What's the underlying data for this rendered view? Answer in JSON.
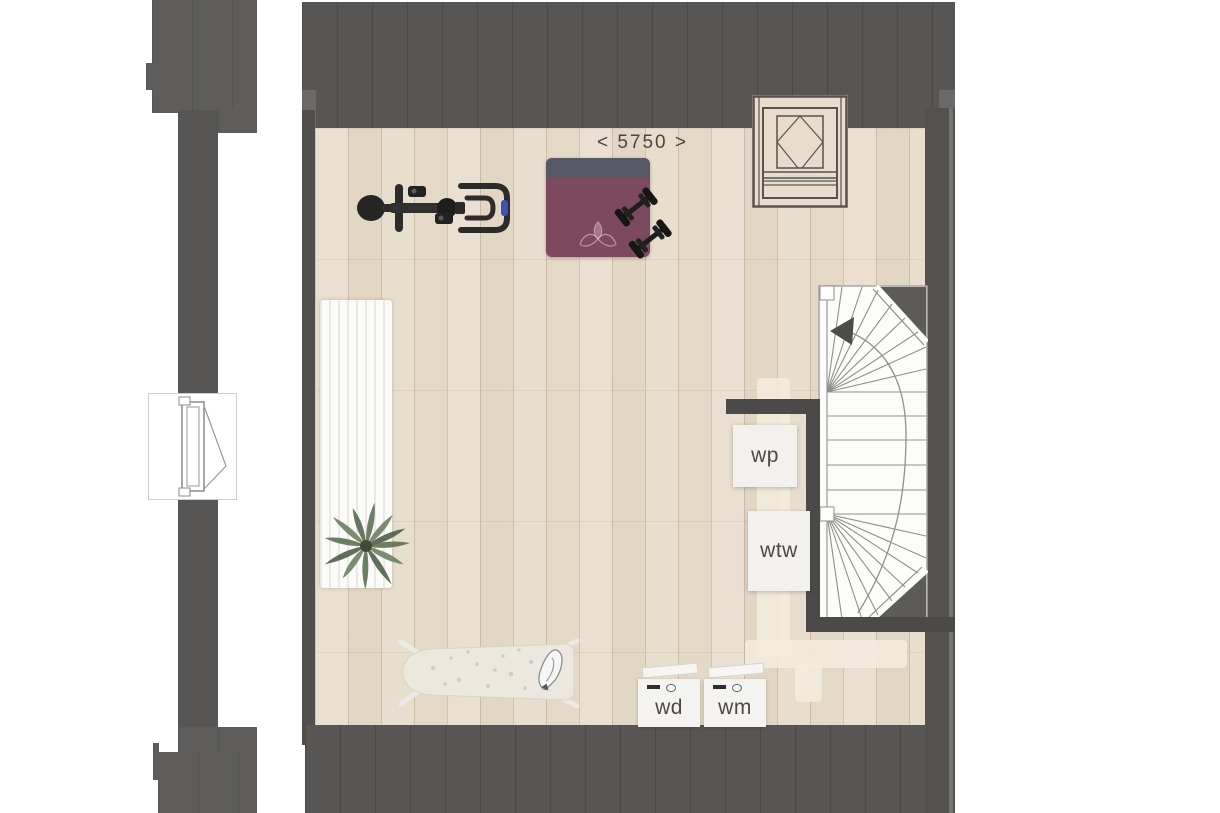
{
  "plan": {
    "dimension_label": "< 5750 >",
    "labels": {
      "wp": "wp",
      "wtw": "wtw",
      "wd": "wd",
      "wm": "wm"
    },
    "icons": [
      "exercise-bike-icon",
      "yoga-mat-icon",
      "dumbbells-icon",
      "rug-icon",
      "plant-icon",
      "ironing-board-icon",
      "iron-icon",
      "washer-icon",
      "dryer-icon",
      "roof-window-icon",
      "tilt-window-icon",
      "staircase-icon",
      "stair-direction-arrow-icon",
      "duct-icon"
    ],
    "colors": {
      "roof_wall": "#575654",
      "left_wall": "#5e5d5b",
      "interior_wall": "#4b4a48",
      "floor_wood": "#e8ddcc",
      "stair_fill": "#fcfcfb",
      "stair_line": "#908f8d",
      "yoga_mat": "#7d495e",
      "yoga_mat_roll": "#585765",
      "duct": "#f2ecdd",
      "label_text": "#4b4a48",
      "plant": "#5c7052",
      "equipment_dark": "#2a2a28",
      "bike_accent": "#3f4fb8"
    }
  }
}
